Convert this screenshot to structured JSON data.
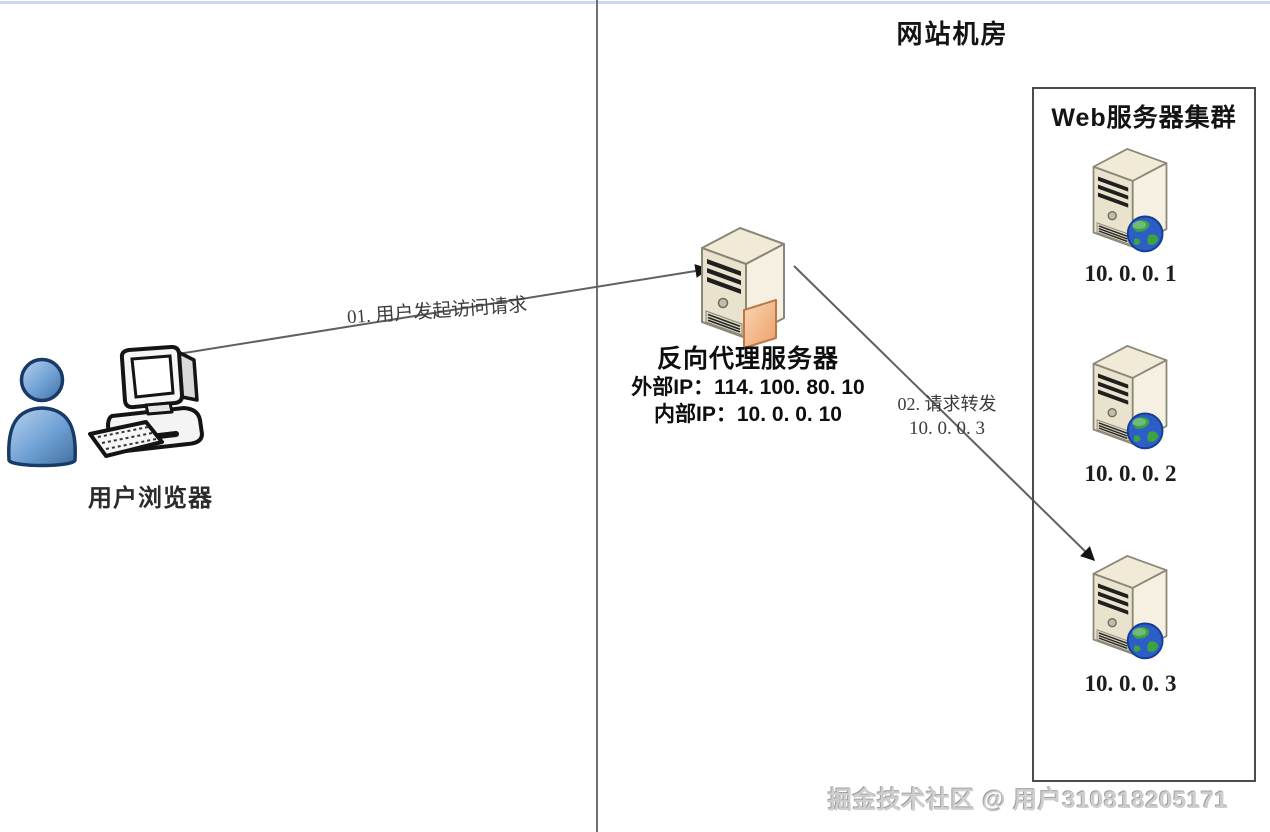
{
  "header": {
    "title": "网站机房"
  },
  "client": {
    "label": "用户浏览器"
  },
  "proxy": {
    "label": "反向代理服务器",
    "external_ip": "外部IP：114. 100. 80. 10",
    "internal_ip": "内部IP：10. 0. 0. 10"
  },
  "flows": {
    "request": {
      "label": "01. 用户发起访问请求"
    },
    "forward": {
      "label": "02. 请求转发",
      "target_ip": "10. 0. 0. 3"
    }
  },
  "cluster": {
    "title": "Web服务器集群",
    "servers": [
      {
        "ip": "10. 0. 0. 1"
      },
      {
        "ip": "10. 0. 0. 2"
      },
      {
        "ip": "10. 0. 0. 3"
      }
    ]
  },
  "watermark": {
    "text": "掘金技术社区 @ 用户310818205171"
  },
  "icons": {
    "client": [
      "person-icon",
      "desktop-computer-icon"
    ],
    "proxy": "tower-server-icon",
    "web_server": "tower-server-with-globe-icon"
  },
  "colors": {
    "server_body": "#f0ead6",
    "server_outline": "#8b8778",
    "globe_blue": "#2d5ec7",
    "globe_green": "#3ba33f",
    "proxy_card_orange": "#f2b183",
    "person_blue": "#6fa0d4",
    "connector_gray": "#606060",
    "divider_gray": "#707070",
    "top_strip_blue": "#ccd7f0",
    "watermark_gray": "#cecece"
  }
}
